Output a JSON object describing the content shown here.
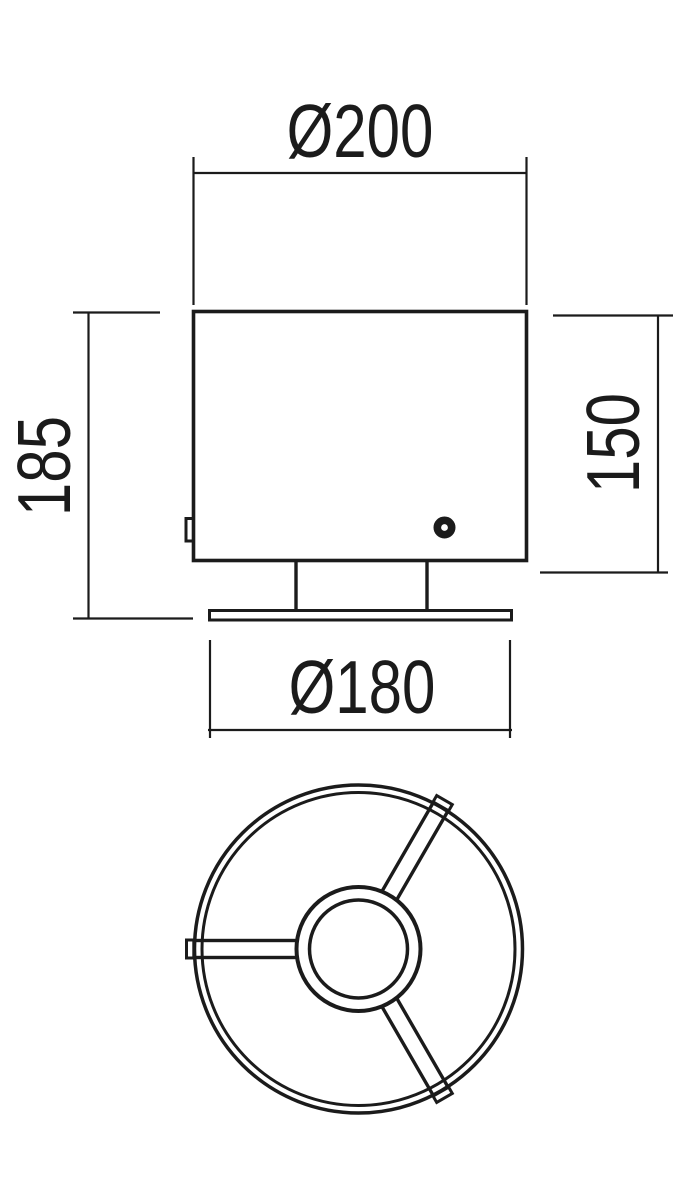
{
  "drawing": {
    "dimensions": {
      "shade_diameter": {
        "label": "Ø200"
      },
      "total_height": {
        "label": "185"
      },
      "shade_height": {
        "label": "150"
      },
      "base_diameter": {
        "label": "Ø180"
      }
    },
    "colors": {
      "line": "#1b1b1b",
      "background": "#ffffff"
    }
  }
}
